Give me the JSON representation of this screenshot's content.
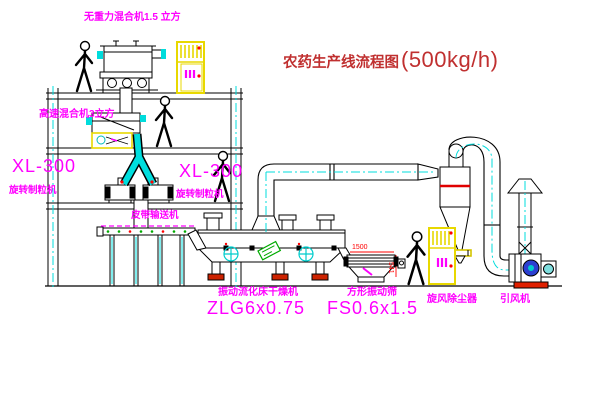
{
  "title": {
    "name": "农药生产线流程图",
    "capacity": "(500kg/h)"
  },
  "equipment_labels": {
    "gravity_mixer": "无重力混合机1.5 立方",
    "high_speed_mixer": "高速混合机3立方",
    "granulator_left_model": "XL-300",
    "granulator_left_name": "旋转制粒机",
    "granulator_right_model": "XL-300",
    "granulator_right_name": "旋转制粒机",
    "belt_conveyor": "皮带输送机",
    "fluid_bed_dryer_name": "振动流化床干燥机",
    "fluid_bed_dryer_model": "ZLG6x0.75",
    "square_sieve_name": "方形振动筛",
    "square_sieve_model": "FS0.6x1.5",
    "cyclone": "旋风除尘器",
    "induced_draft_fan": "引风机"
  },
  "dimensions": {
    "sieve_length": "1500",
    "sieve_height": "541"
  },
  "colors": {
    "label_magenta": "#ff00ff",
    "title_red": "#c03030",
    "line_cyan": "#00dcdc",
    "cabinet_yellow": "#e8d800",
    "accent_red": "#ff0000",
    "accent_green": "#00aa00",
    "fan_blue": "#2b3fd0"
  }
}
